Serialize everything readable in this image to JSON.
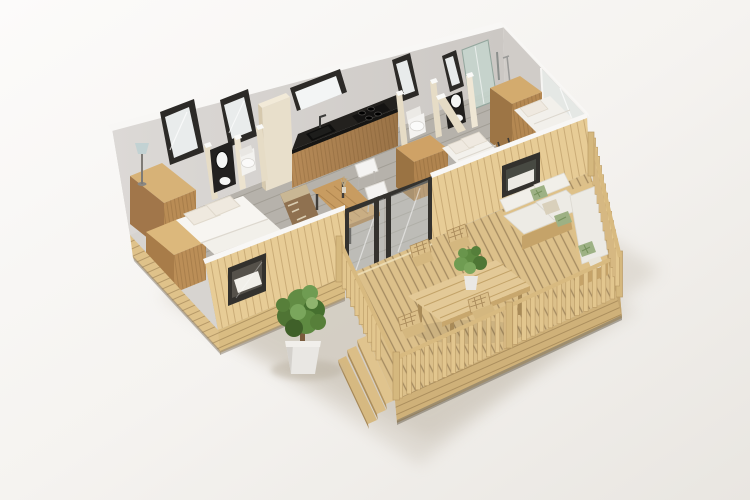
{
  "scene": {
    "type": "isometric-3d-floorplan-render",
    "subject": "Holiday mobile home cutaway with wooden terrace",
    "view": "top-down isometric, roof removed",
    "background": "plain light studio backdrop"
  },
  "palette": {
    "background_top": "#fbfaf8",
    "background_bottom": "#eae7e2",
    "shadow": "#c9c1b3",
    "wall_grey": "#d6d3cf",
    "wall_grey_dark": "#d0ccc8",
    "wall_top_white": "#f8f7f5",
    "east_glass": "#e6e9e7",
    "floor_inside": "#b6b2ab",
    "partition_cream": "#e6dcc6",
    "partition_cream_light": "#efe7d5",
    "window_frame": "#2c2a27",
    "glass": "#e9ecec",
    "shower_glass": "#c5d4cc",
    "kitchen_wood": "#ad8152",
    "kitchen_wood_dark": "#8f6a42",
    "counter_black": "#23211e",
    "wardrobe_top": "#d7b277",
    "wardrobe_front": "#b98c55",
    "wardrobe_side": "#a1764a",
    "linen_white": "#f2f0ea",
    "pillow_white": "#efe9df",
    "table_wood": "#c89c61",
    "chair_white": "#f4f3f1",
    "exterior_wood": "#e7cc96",
    "skirt_wood": "#d9bc82",
    "skirt_shadow": "#8c8272",
    "deck_board": "#dcc08a",
    "railing_wood": "#e2c68e",
    "railing_edge": "#b99a65",
    "sofa_cushion": "#edebe5",
    "pillow_green": "#9db184",
    "pillow_beige": "#d9d0bb",
    "sofa_wood": "#dec189",
    "plant_green": "#5e8a41",
    "plant_green_dark": "#3f6029",
    "plant_green_light": "#7aa65c",
    "pot_white": "#e9e7e3",
    "ladder_dark": "#3a3835",
    "lamp_shade": "#c2d2d3"
  },
  "rooms": [
    {
      "name": "master-bedroom",
      "furniture": [
        "double-bed",
        "stepped-wardrobe",
        "floor-lamp",
        "two-back-windows",
        "front-window"
      ]
    },
    {
      "name": "bathroom-1",
      "furniture": [
        "black-vanity",
        "oval-mirror",
        "washbasin",
        "toilet"
      ]
    },
    {
      "name": "wc",
      "furniture": [
        "toilet",
        "tall-window"
      ]
    },
    {
      "name": "bathroom-2",
      "furniture": [
        "black-vanity",
        "round-mirror",
        "washbasin",
        "corner-shower"
      ]
    },
    {
      "name": "kitchen",
      "furniture": [
        "wood-base-cabinets",
        "black-counter",
        "sink",
        "induction-cooktop",
        "wide-window",
        "tall-cream-cabinet"
      ]
    },
    {
      "name": "living-dining",
      "furniture": [
        "wood-dining-table",
        "two-white-chairs",
        "banquette-bench",
        "wood-sideboard",
        "sliding-glass-door"
      ]
    },
    {
      "name": "kids-bedroom",
      "furniture": [
        "single-bed",
        "single-bed",
        "bunk-ladder",
        "wardrobe",
        "front-window",
        "glass-end-wall"
      ]
    },
    {
      "name": "terrace",
      "furniture": [
        "outdoor-dining-table",
        "four-wood-chairs",
        "corner-lounge-sofa",
        "green-leaf-pillows",
        "slatted-railing",
        "three-steps",
        "table-plant"
      ]
    }
  ],
  "exterior": [
    "potted-green-bush",
    "wood-plank-cladding",
    "deck-skirt"
  ],
  "counts": {
    "back_wall_windows": 5,
    "outdoor_chairs": 4,
    "steps": 3,
    "beds": 3
  }
}
